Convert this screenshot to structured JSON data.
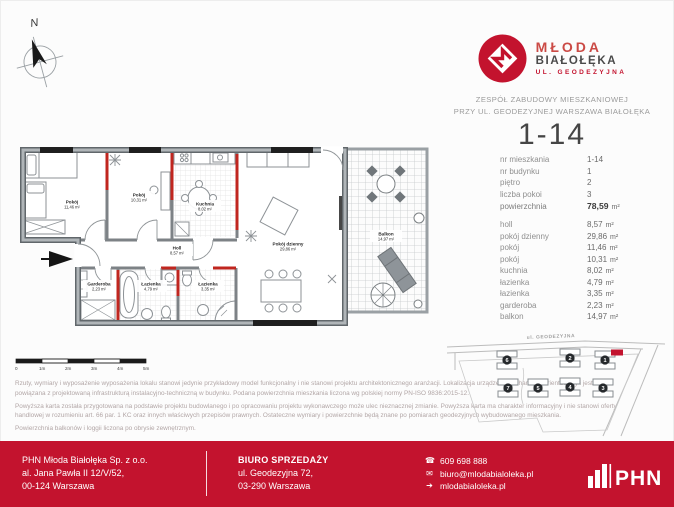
{
  "colors": {
    "accent_red": "#c3132e",
    "logo_light_red": "#cb4a45",
    "wall_gray": "#a7acb0",
    "red_wall": "#c0261f",
    "disclaimer_text": "#b2a6a6"
  },
  "compass": {
    "north_label": "N"
  },
  "brand": {
    "name_line1": "MŁODA",
    "name_line2": "BIAŁOŁĘKA",
    "name_line3": "UL. GEODEZYJNA",
    "tagline_line1": "ZESPÓŁ ZABUDOWY MIESZKANIOWEJ",
    "tagline_line2": "PRZY UL. GEODEZYJNEJ WARSZAWA BIAŁOŁĘKA"
  },
  "unit_card": {
    "number": "1-14",
    "details": [
      {
        "label": "nr mieszkania",
        "value": "1-14",
        "unit": ""
      },
      {
        "label": "nr budynku",
        "value": "1",
        "unit": ""
      },
      {
        "label": "piętro",
        "value": "2",
        "unit": ""
      },
      {
        "label": "liczba pokoi",
        "value": "3",
        "unit": ""
      },
      {
        "label": "powierzchnia",
        "value": "78,59",
        "unit": "m²"
      }
    ],
    "rooms": [
      {
        "label": "holl",
        "value": "8,57",
        "unit": "m²"
      },
      {
        "label": "pokój dzienny",
        "value": "29,86",
        "unit": "m²"
      },
      {
        "label": "pokój",
        "value": "11,46",
        "unit": "m²"
      },
      {
        "label": "pokój",
        "value": "10,31",
        "unit": "m²"
      },
      {
        "label": "kuchnia",
        "value": "8,02",
        "unit": "m²"
      },
      {
        "label": "łazienka",
        "value": "4,79",
        "unit": "m²"
      },
      {
        "label": "łazienka",
        "value": "3,35",
        "unit": "m²"
      },
      {
        "label": "garderoba",
        "value": "2,23",
        "unit": "m²"
      },
      {
        "label": "balkon",
        "value": "14,97",
        "unit": "m²"
      }
    ]
  },
  "floorplan": {
    "labels": [
      {
        "name": "Pokój",
        "area": "11,46 m²"
      },
      {
        "name": "Pokój",
        "area": "10,31 m²"
      },
      {
        "name": "Kuchnia",
        "area": "8,02 m²"
      },
      {
        "name": "Pokój dzienny",
        "area": "29,86 m²"
      },
      {
        "name": "Holl",
        "area": "8,57 m²"
      },
      {
        "name": "Garderoba",
        "area": "2,23 m²"
      },
      {
        "name": "Łazienka",
        "area": "4,79 m²"
      },
      {
        "name": "Łazienka",
        "area": "3,35 m²"
      },
      {
        "name": "Balkon",
        "area": "14,97 m²"
      }
    ],
    "scale": [
      "0",
      "1m",
      "2m",
      "3m",
      "4m",
      "5m"
    ]
  },
  "sitemap": {
    "street_label": "ul. GEODEZYJNA",
    "buildings": [
      "6",
      "2",
      "1",
      "7",
      "5",
      "4",
      "3"
    ]
  },
  "disclaimer": {
    "p1": "Rzuty, wymiary i wyposażenie wyposażenia lokalu stanowi jedynie przykładowy model funkcjonalny i nie stanowi projektu architektonicznego aranżacji. Lokalizacja urządzeń ma charakter orientacyjny i jest powiązana z projektowaną infrastrukturą instalacyjno-techniczną w budynku. Podana powierzchnia mieszkania liczona wg polskiej normy PN-ISO 9836:2015-12.",
    "p2": "Powyższa karta została przygotowana na podstawie projektu budowlanego i po opracowaniu projektu wykonawczego może ulec nieznacznej zmianie. Powyższa karta ma charakter informacyjny i nie stanowi oferty handlowej w rozumieniu art. 66 par. 1 KC oraz innych właściwych przepisów prawnych. Ostateczne wymiary i powierzchnie będą znane po pomiarach geodezyjnych wybudowanego mieszkania.",
    "p3": "Powierzchnia balkonów i loggii liczona po obrysie zewnętrznym."
  },
  "footer": {
    "company": {
      "name": "PHN Młoda Białołęka Sp. z o.o.",
      "address_line1": "al. Jana Pawła II 12/V/52,",
      "address_line2": "00-124 Warszawa"
    },
    "sales_office": {
      "title": "BIURO SPRZEDAŻY",
      "address_line1": "ul. Geodezyjna 72,",
      "address_line2": "03-290 Warszawa"
    },
    "contact": {
      "phone": "609 698 888",
      "email": "biuro@mlodabialoleka.pl",
      "website": "mlodabialoleka.pl"
    },
    "icons": {
      "phone": "☎",
      "email": "✉",
      "website": "➔"
    },
    "logo_text": "PHN"
  }
}
